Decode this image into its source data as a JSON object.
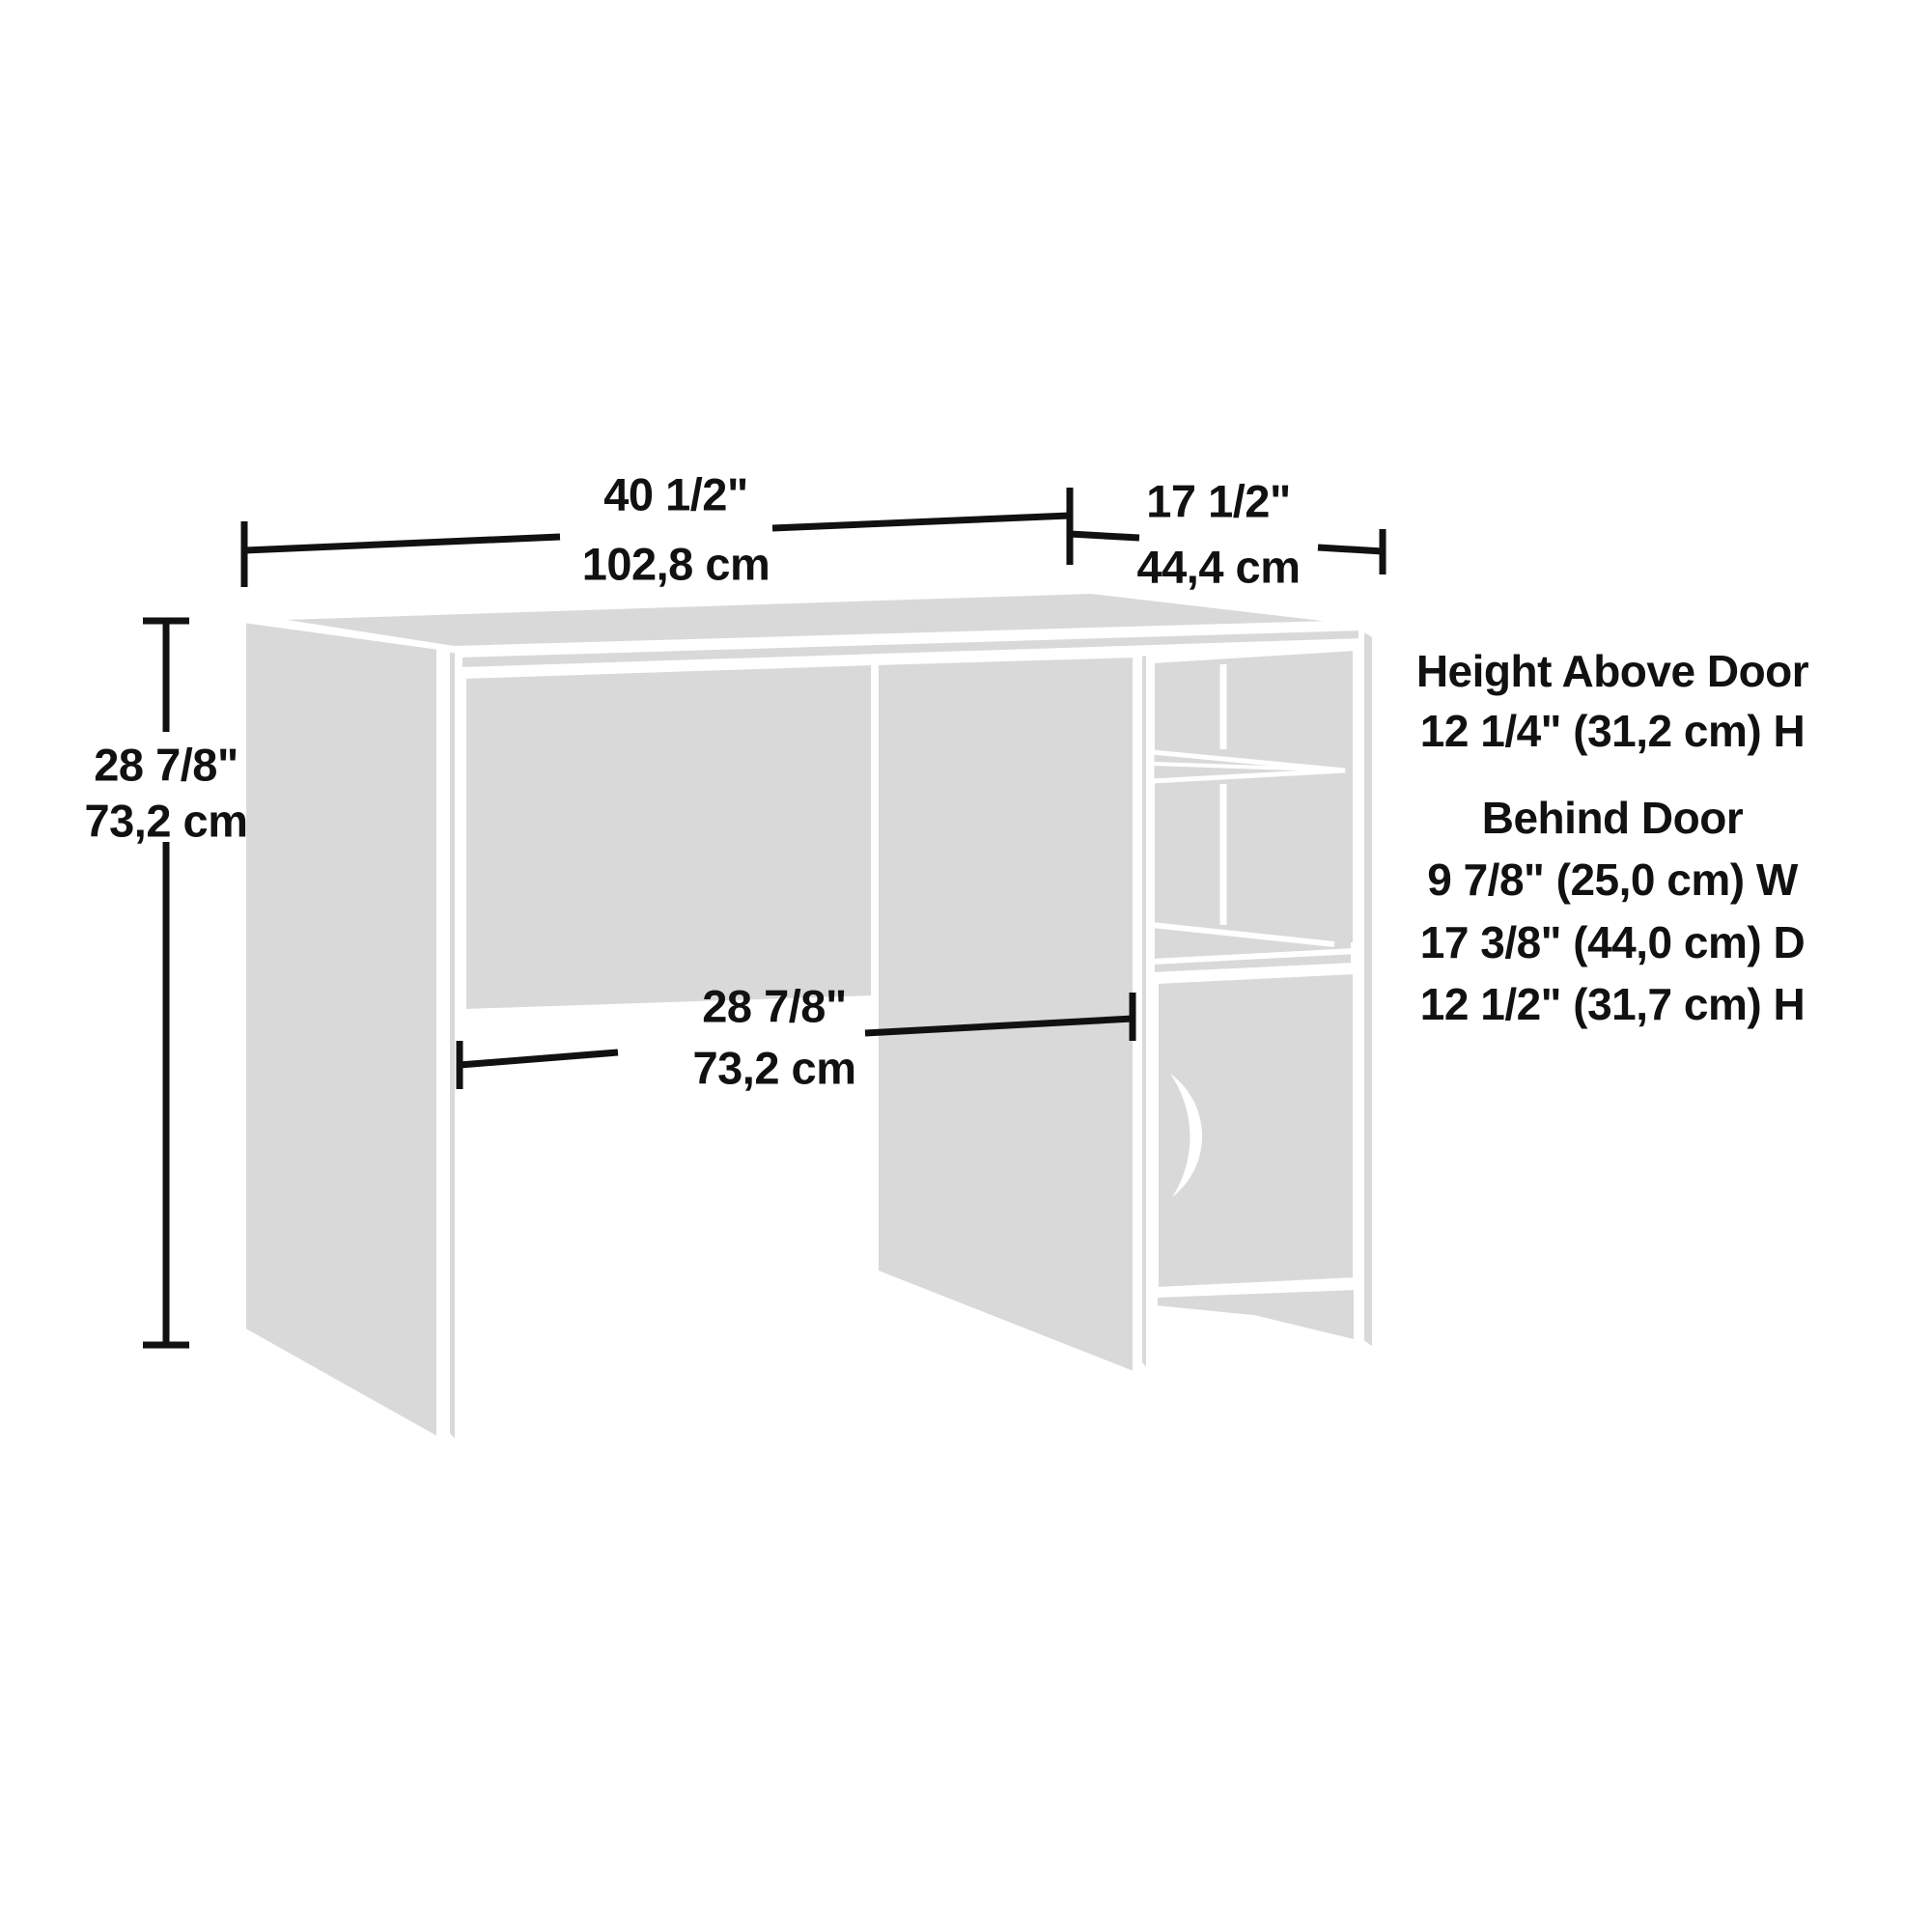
{
  "title": "Desk dimension diagram",
  "colors": {
    "panel": "#d9d9d9",
    "line": "#111111",
    "background": "#ffffff"
  },
  "dimensions": {
    "width": {
      "inches": "40 1/2\"",
      "cm": "102,8 cm"
    },
    "depth": {
      "inches": "17 1/2\"",
      "cm": "44,4 cm"
    },
    "height": {
      "inches": "28 7/8\"",
      "cm": "73,2 cm"
    },
    "kneehole": {
      "inches": "28 7/8\"",
      "cm": "73,2 cm"
    }
  },
  "annotations": {
    "above_door_title": "Height Above Door",
    "above_door_dims": "12 1/4\" (31,2 cm) H",
    "behind_door_title": "Behind Door",
    "behind_door_width": "9 7/8\" (25,0 cm) W",
    "behind_door_depth": "17 3/8\" (44,0 cm) D",
    "behind_door_height": "12 1/2\" (31,7 cm) H"
  }
}
